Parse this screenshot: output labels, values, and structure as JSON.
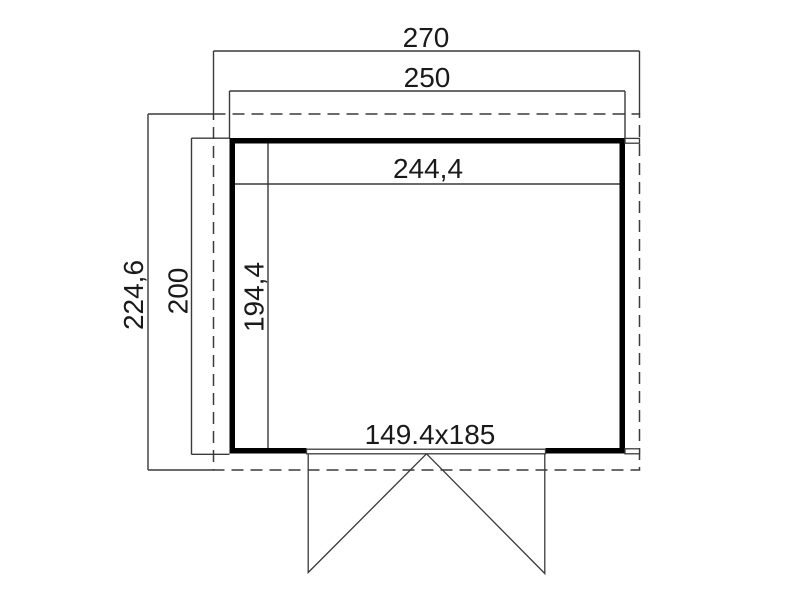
{
  "drawing": {
    "type": "shed-floor-plan",
    "colors": {
      "wall": "#000000",
      "line": "#3a3a3a",
      "text": "#1a1a1a"
    },
    "dimensions": {
      "roof_width": "270",
      "body_width": "250",
      "inner_width": "244,4",
      "roof_depth": "224,6",
      "body_depth": "200",
      "inner_depth": "194,4",
      "door_size": "149.4x185"
    }
  }
}
